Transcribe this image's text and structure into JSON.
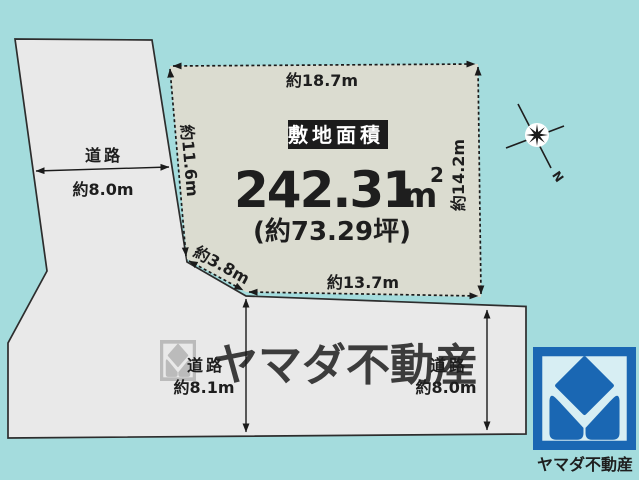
{
  "colors": {
    "background": "#a4dcdd",
    "road_fill": "#e9e9e9",
    "road_stroke": "#2d2d2d",
    "parcel_fill": "#dbdcd0",
    "line_color": "#1b1b1b",
    "label_box_bg": "#1c1c1c",
    "watermark": "#b4b4b3",
    "logo_blue": "#1a67b3",
    "logo_bg": "#d7eef3"
  },
  "parcel": {
    "area_caption": "敷地面積",
    "area_value": "242.31",
    "area_unit": "m",
    "area_unit_exp": "2",
    "area_tsubo": "(約73.29坪)",
    "dims": {
      "top": "約18.7m",
      "right": "約14.2m",
      "bottom": "約13.7m",
      "left": "約11.6m",
      "diagonal": "約3.8m"
    }
  },
  "roads": {
    "left": {
      "label": "道路",
      "width": "約8.0m"
    },
    "bottom_left": {
      "label": "道路",
      "width": "約8.1m"
    },
    "bottom_right": {
      "label": "道路",
      "width": "約8.0m"
    }
  },
  "compass": {
    "north_label": "N"
  },
  "watermark": {
    "text": "ヤマダ不動産"
  },
  "logo": {
    "company": "ヤマダ不動産"
  }
}
